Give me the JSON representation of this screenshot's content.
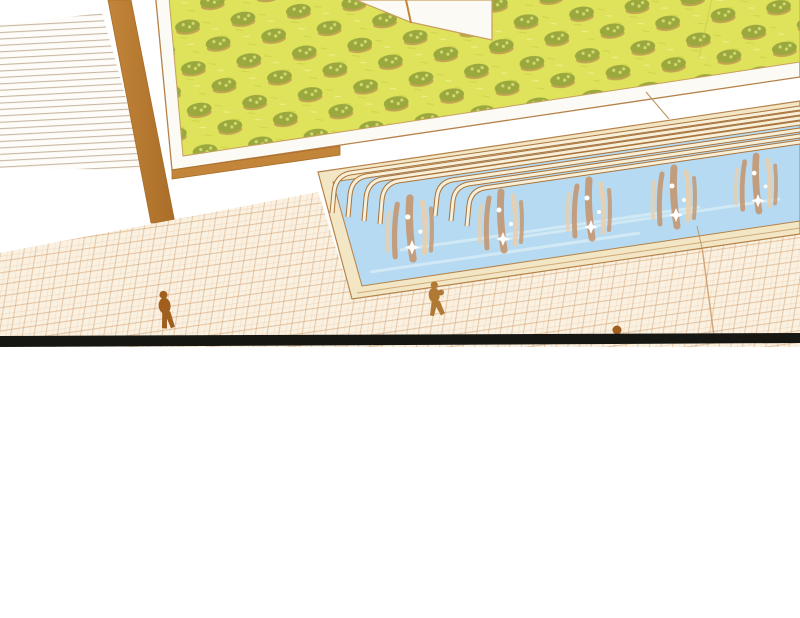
{
  "panel": {
    "kind": "comic-scene-panel",
    "width": 800,
    "height": 618,
    "description": "Aerial isometric view of a courtyard: striped stairs top-left, raised garden bed of hedge rows, long fountain pool with curved water spouts, checkered tile plaza with three tiny pedestrians, thick black panel border line, blank white area below"
  },
  "scene": {
    "figure_count": 3,
    "water_spout_count": 7,
    "splash_count": 5,
    "hedge_rows_visible": 8
  },
  "colors": {
    "paper_white": "#ffffff",
    "cream_white": "#fcfaf4",
    "stair_bg": "#fdfcf8",
    "stair_line": "#c9b7a2",
    "wall_brown": "#c3853a",
    "wall_brown_dark": "#a96d28",
    "grass_base": "#dfe35c",
    "grass_texture": "#cdd548",
    "grass_light": "#edf18d",
    "bush_green": "#9aa83e",
    "bush_light": "#ced96e",
    "bush_shadow": "#b98f4f",
    "frame_outline": "#b5824a",
    "frame_inner_outline": "#c8a05f",
    "pool_coping": "#f3e6c4",
    "pool_water": "#b5daf1",
    "water_light": "#ddeef8",
    "rail_brown": "#a9743d",
    "rail_cream": "#f7efd8",
    "splash_tan": "#c5936a",
    "splash_light": "#e9cfae",
    "sparkle_white": "#ffffff",
    "tile_base": "#faf1e1",
    "tile_line": "#d09c6a",
    "figure_brown": "#a05f1f",
    "figure_brown_2": "#b07a35",
    "black_band": "#161613",
    "seam_line": "#bd9a6b",
    "grass_seam": "#c2bb4e"
  }
}
